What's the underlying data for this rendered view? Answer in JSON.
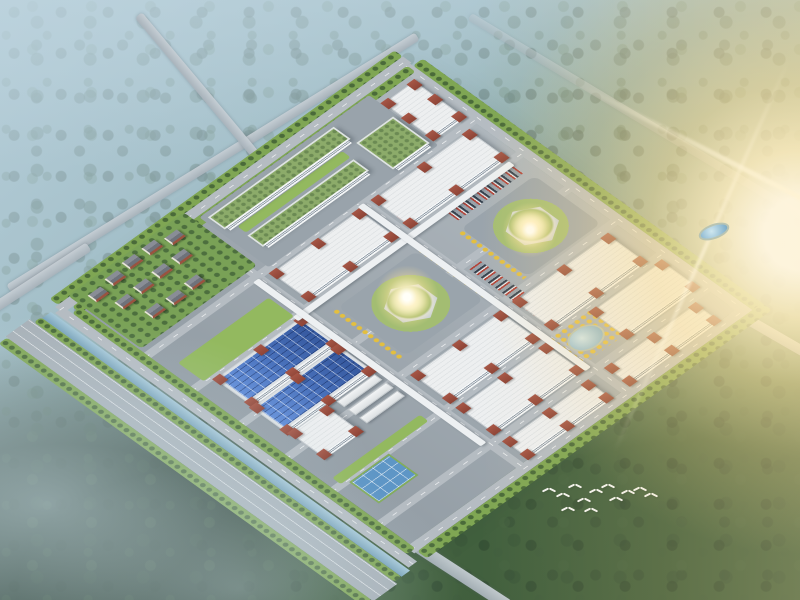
{
  "colors": {
    "water": "#7aa4bb",
    "lawn": "#93b95f",
    "treebelt": "#7fa653",
    "roof": "#edeff0",
    "brick": "#8e4436",
    "solar": "#3f6cc0",
    "greenroof": "#8cab6a",
    "court": "#5e96c6",
    "ytree": "#e4bf3e",
    "haze": "#a3bfca",
    "forest_dark": "#31493a",
    "sun": "#ffedb8"
  },
  "plane": {
    "left": 180,
    "top": 80,
    "size": 460,
    "elements": [
      {
        "type": "avenue",
        "name": "boulevard-southwest",
        "x": -82,
        "y": -30,
        "w": 34,
        "h": 520
      },
      {
        "type": "lawnbelt",
        "name": "tree-belt-outer-southwest",
        "x": -94,
        "y": -28,
        "w": 12,
        "h": 516
      },
      {
        "type": "lawnbelt",
        "name": "tree-belt-canal-side",
        "x": -48,
        "y": -24,
        "w": 10,
        "h": 510
      },
      {
        "type": "canal",
        "name": "canal-southwest",
        "x": -38,
        "y": -22,
        "w": 12,
        "h": 508
      },
      {
        "type": "roadv",
        "name": "perimeter-road-southwest",
        "x": -24,
        "y": -18,
        "w": 12,
        "h": 500
      },
      {
        "type": "roadh",
        "name": "perimeter-road-northwest",
        "x": -18,
        "y": -24,
        "w": 492,
        "h": 12
      },
      {
        "type": "lawnbelt",
        "name": "tree-belt-northwest",
        "x": -14,
        "y": -36,
        "w": 488,
        "h": 12
      },
      {
        "type": "roadv",
        "name": "perimeter-road-northeast",
        "x": 460,
        "y": -12,
        "w": 12,
        "h": 486
      },
      {
        "type": "lawnbelt",
        "name": "tree-belt-northeast",
        "x": 472,
        "y": -8,
        "w": 14,
        "h": 486
      },
      {
        "type": "roadh",
        "name": "perimeter-road-southeast",
        "x": -6,
        "y": 460,
        "w": 486,
        "h": 12
      },
      {
        "type": "lawnbelt",
        "name": "tree-belt-southeast",
        "x": -2,
        "y": 472,
        "w": 488,
        "h": 14
      },
      {
        "type": "lawnbelt",
        "name": "green-edge-north",
        "x": -6,
        "y": -12,
        "w": 474,
        "h": 12
      },
      {
        "type": "lawnbelt",
        "name": "green-edge-west",
        "x": -12,
        "y": -6,
        "w": 12,
        "h": 474
      },
      {
        "type": "roadh",
        "name": "campus-road-h1",
        "x": -4,
        "y": 84,
        "w": 466,
        "h": 10
      },
      {
        "type": "roadh",
        "name": "campus-road-h2",
        "x": -4,
        "y": 150,
        "w": 466,
        "h": 10
      },
      {
        "type": "roadh",
        "name": "campus-road-h3",
        "x": -4,
        "y": 218,
        "w": 466,
        "h": 10
      },
      {
        "type": "roadh",
        "name": "campus-road-h4",
        "x": -4,
        "y": 283,
        "w": 466,
        "h": 10
      },
      {
        "type": "roadh",
        "name": "campus-road-h5",
        "x": -4,
        "y": 348,
        "w": 466,
        "h": 10
      },
      {
        "type": "roadh",
        "name": "campus-road-h6",
        "x": -4,
        "y": 414,
        "w": 466,
        "h": 10
      },
      {
        "type": "roadv",
        "name": "campus-road-v1",
        "x": 150,
        "y": -4,
        "w": 10,
        "h": 466
      },
      {
        "type": "roadv",
        "name": "campus-road-v2",
        "x": 298,
        "y": -4,
        "w": 10,
        "h": 466
      },
      {
        "type": "rez-zone",
        "name": "residential-quarter",
        "x": 2,
        "y": -26,
        "w": 164,
        "h": 104
      },
      {
        "type": "zone",
        "name": "office-campus-ground",
        "x": 172,
        "y": -10,
        "w": 240,
        "h": 98
      },
      {
        "type": "plaza",
        "name": "plaza-central",
        "x": 182,
        "y": 176,
        "w": 110,
        "h": 96
      },
      {
        "type": "plaza",
        "name": "plaza-east",
        "x": 346,
        "y": 186,
        "w": 104,
        "h": 94
      },
      {
        "type": "lawn",
        "name": "lawn-west",
        "x": 14,
        "y": 118,
        "w": 128,
        "h": 36
      },
      {
        "type": "lawn",
        "name": "lawn-southwest",
        "x": 10,
        "y": 340,
        "w": 124,
        "h": 12
      },
      {
        "type": "ytrees",
        "name": "yellow-trees-plaza-west",
        "x": 172,
        "y": 176,
        "w": 10,
        "h": 96
      },
      {
        "type": "ytrees",
        "name": "yellow-trees-plaza-mid",
        "x": 292,
        "y": 176,
        "w": 10,
        "h": 96
      },
      {
        "type": "ytrees",
        "name": "yellow-trees-plaza-east",
        "x": 338,
        "y": 188,
        "w": 8,
        "h": 92
      },
      {
        "type": "ytrees",
        "name": "yellow-trees-pond",
        "x": 296,
        "y": 356,
        "w": 60,
        "h": 50
      },
      {
        "type": "parking",
        "name": "parking-north-1",
        "x": 188,
        "y": 128,
        "w": 102,
        "h": 18
      },
      {
        "type": "parking",
        "name": "parking-north-2",
        "x": 312,
        "y": 128,
        "w": 104,
        "h": 18
      },
      {
        "type": "parking",
        "name": "parking-east",
        "x": 352,
        "y": 162,
        "w": 92,
        "h": 14
      },
      {
        "type": "parkv",
        "name": "parking-central-south",
        "x": 312,
        "y": 232,
        "w": 16,
        "h": 92
      },
      {
        "type": "greenroof",
        "name": "office-block-north",
        "x": 178,
        "y": -4,
        "w": 178,
        "h": 24
      },
      {
        "type": "lawn",
        "name": "office-courtyard",
        "x": 190,
        "y": 26,
        "w": 148,
        "h": 12
      },
      {
        "type": "greenroof",
        "name": "office-block-south",
        "x": 188,
        "y": 42,
        "w": 150,
        "h": 22
      },
      {
        "type": "greenroof",
        "name": "office-block-square",
        "x": 356,
        "y": 28,
        "w": 52,
        "h": 52
      },
      {
        "type": "factory",
        "name": "factory-north-corner",
        "x": 414,
        "y": 8,
        "w": 44,
        "h": 66
      },
      {
        "type": "factory",
        "name": "factory-b1",
        "x": 168,
        "y": 96,
        "w": 124,
        "h": 48
      },
      {
        "type": "factory",
        "name": "factory-b2",
        "x": 312,
        "y": 96,
        "w": 136,
        "h": 48
      },
      {
        "type": "solar",
        "name": "factory-solar-1",
        "x": 24,
        "y": 160,
        "w": 122,
        "h": 48
      },
      {
        "type": "solar",
        "name": "factory-solar-2",
        "x": 22,
        "y": 214,
        "w": 122,
        "h": 46
      },
      {
        "type": "factory",
        "name": "factory-dormitory",
        "x": 24,
        "y": 266,
        "w": 52,
        "h": 44
      },
      {
        "type": "shed",
        "name": "warehouse-1",
        "x": 88,
        "y": 268,
        "w": 54,
        "h": 11
      },
      {
        "type": "shed",
        "name": "warehouse-2",
        "x": 88,
        "y": 284,
        "w": 54,
        "h": 11
      },
      {
        "type": "shed",
        "name": "warehouse-3",
        "x": 88,
        "y": 300,
        "w": 54,
        "h": 11
      },
      {
        "type": "factory",
        "name": "factory-e1",
        "x": 168,
        "y": 296,
        "w": 124,
        "h": 48
      },
      {
        "type": "factory",
        "name": "factory-e2",
        "x": 312,
        "y": 296,
        "w": 132,
        "h": 48
      },
      {
        "type": "court",
        "name": "sports-court",
        "x": 18,
        "y": 356,
        "w": 56,
        "h": 42
      },
      {
        "type": "factory",
        "name": "factory-f1",
        "x": 168,
        "y": 360,
        "w": 124,
        "h": 46
      },
      {
        "type": "factory",
        "name": "factory-f2",
        "x": 356,
        "y": 360,
        "w": 100,
        "h": 46
      },
      {
        "type": "pond",
        "name": "ornamental-pond",
        "x": 306,
        "y": 366,
        "w": 42,
        "h": 32
      },
      {
        "type": "factory",
        "name": "factory-g1",
        "x": 168,
        "y": 426,
        "w": 118,
        "h": 28
      },
      {
        "type": "factory",
        "name": "factory-g2",
        "x": 312,
        "y": 426,
        "w": 126,
        "h": 28
      },
      {
        "type": "hex",
        "name": "hex-pavilion-central",
        "x": 210,
        "y": 196,
        "w": 54,
        "h": 56,
        "z": 4
      },
      {
        "type": "hex",
        "name": "hex-pavilion-east",
        "x": 372,
        "y": 206,
        "w": 54,
        "h": 56,
        "z": 4
      },
      {
        "type": "corridor",
        "name": "sky-corridor-main",
        "x": 140,
        "y": 154,
        "w": 306,
        "h": 8,
        "z": 5
      },
      {
        "type": "corridor",
        "name": "sky-corridor-west",
        "x": 146,
        "y": 92,
        "w": 8,
        "h": 322,
        "z": 5
      },
      {
        "type": "corridor",
        "name": "sky-corridor-east",
        "x": 294,
        "y": 92,
        "w": 8,
        "h": 322,
        "z": 5
      }
    ],
    "houses": [
      [
        16,
        -12
      ],
      [
        44,
        -16
      ],
      [
        72,
        -20
      ],
      [
        100,
        -20
      ],
      [
        126,
        -14
      ],
      [
        28,
        14
      ],
      [
        56,
        12
      ],
      [
        84,
        10
      ],
      [
        112,
        10
      ],
      [
        40,
        44
      ],
      [
        68,
        46
      ],
      [
        96,
        44
      ]
    ]
  },
  "screen": {
    "roads": [
      {
        "name": "highway-west",
        "cx": 213,
        "cy": 162,
        "len": 480,
        "w": 9,
        "ang": -31.7
      },
      {
        "name": "highway-north",
        "cx": 207,
        "cy": 97,
        "len": 215,
        "w": 9,
        "ang": 50
      },
      {
        "name": "road-northeast-far",
        "cx": 637,
        "cy": 117,
        "len": 390,
        "w": 8,
        "ang": 31,
        "op": 0.45
      },
      {
        "name": "road-east-corner",
        "cx": 766,
        "cy": 330,
        "len": 90,
        "w": 10,
        "ang": 30
      },
      {
        "name": "road-south-corner",
        "cx": 458,
        "cy": 573,
        "len": 120,
        "w": 12,
        "ang": 33
      },
      {
        "name": "road-west-corner",
        "cx": 40,
        "cy": 278,
        "len": 115,
        "w": 10,
        "ang": -33
      }
    ],
    "extras": [
      {
        "type": "pond",
        "name": "reservoir-east",
        "x": 698,
        "y": 224,
        "w": 32,
        "h": 15,
        "r": -20
      }
    ],
    "glints": [
      {
        "x": 407,
        "y": 297,
        "s": 64
      },
      {
        "x": 530,
        "y": 230,
        "s": 56
      }
    ],
    "birds": [
      [
        543,
        487
      ],
      [
        557,
        492
      ],
      [
        569,
        483
      ],
      [
        578,
        497
      ],
      [
        590,
        488
      ],
      [
        602,
        483
      ],
      [
        610,
        496
      ],
      [
        622,
        489
      ],
      [
        634,
        486
      ],
      [
        645,
        492
      ],
      [
        585,
        507
      ],
      [
        562,
        506
      ]
    ]
  }
}
